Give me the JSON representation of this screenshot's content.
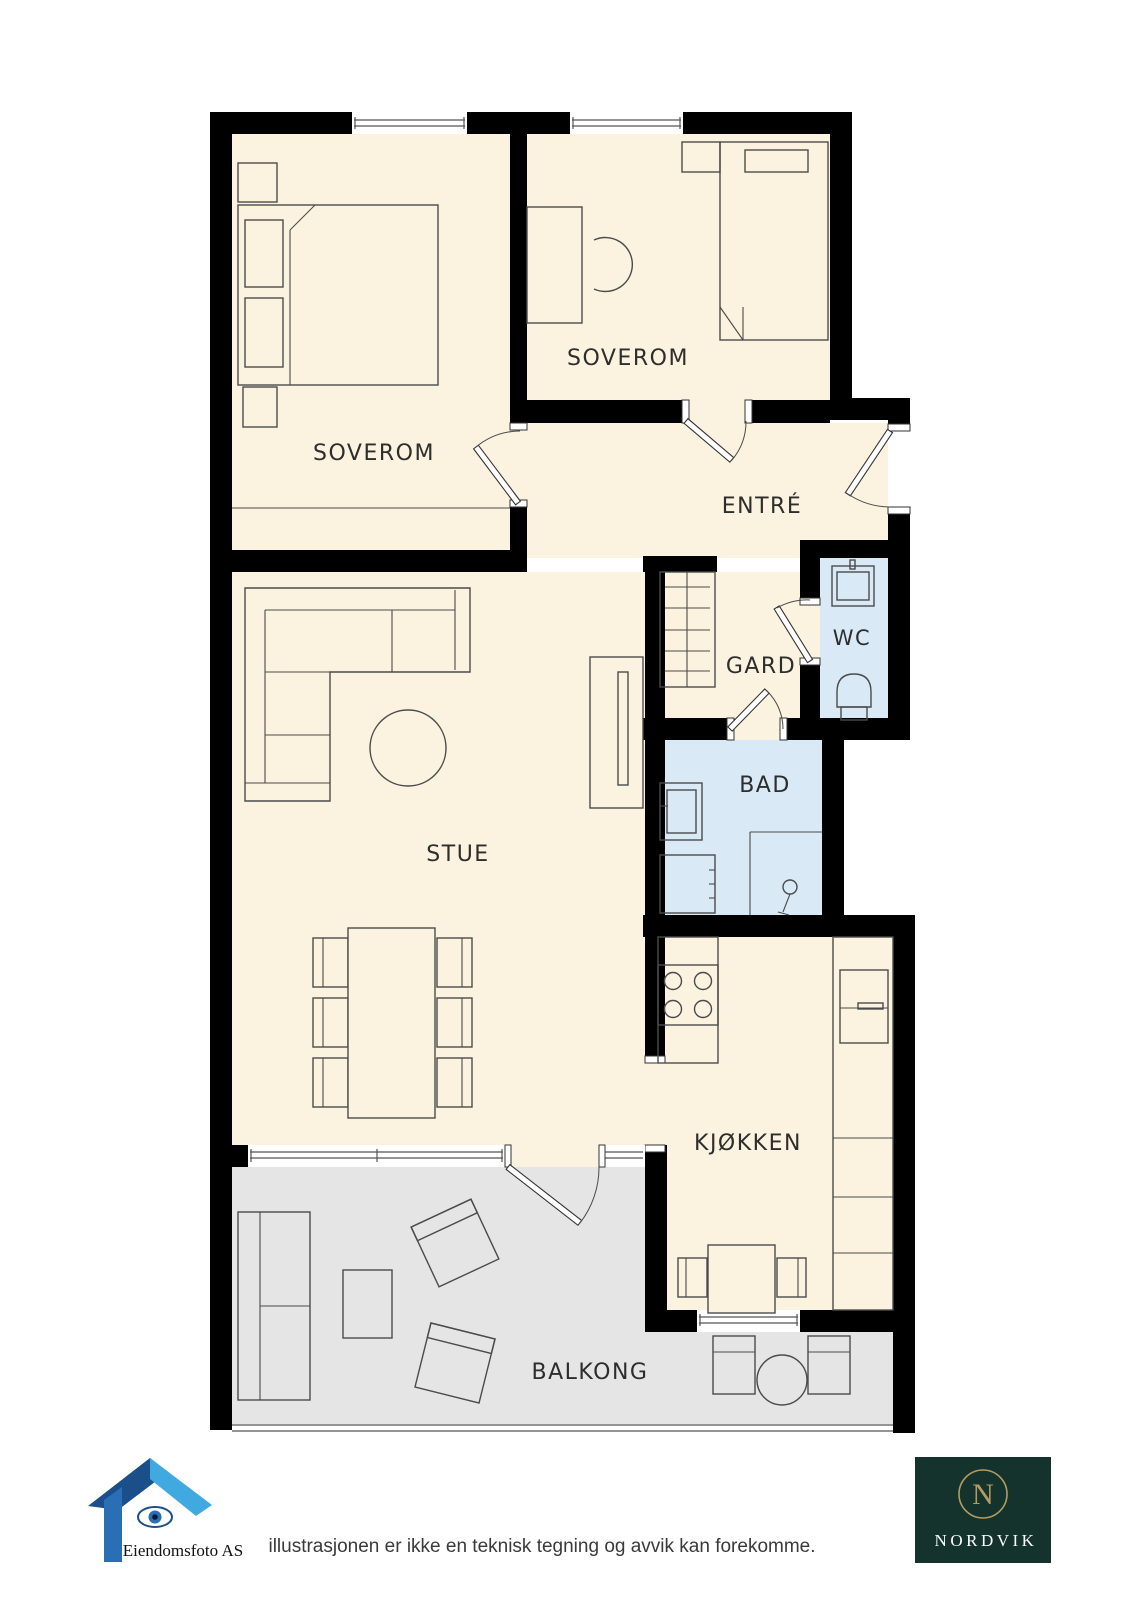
{
  "colors": {
    "background": "#ffffff",
    "wall": "#000000",
    "floor": "#FBF3DF",
    "wet_room": "#D9E9F6",
    "balcony": "#E5E5E5",
    "furniture_outline": "#4b4b4b",
    "label_text": "#2d2d2d",
    "footer_text": "#3a3a3a",
    "nordvik_bg": "#14332D",
    "nordvik_gold": "#B59B62",
    "nordvik_text": "#ffffff",
    "logo_blue_dark": "#1a4f8a",
    "logo_blue_light": "#3fa9e0"
  },
  "rooms": {
    "soverom_left": {
      "label": "SOVEROM"
    },
    "soverom_top": {
      "label": "SOVEROM"
    },
    "entre": {
      "label": "ENTRÉ"
    },
    "gard": {
      "label": "GARD"
    },
    "wc": {
      "label": "WC"
    },
    "bad": {
      "label": "BAD"
    },
    "stue": {
      "label": "STUE"
    },
    "kjokken": {
      "label": "KJØKKEN"
    },
    "balkong": {
      "label": "BALKONG"
    }
  },
  "footer": {
    "disclaimer": "illustrasjonen er ikke en teknisk tegning og avvik kan forekomme.",
    "photo_credit": "Eiendomsfoto AS",
    "brand": "NORDVIK",
    "brand_monogram": "N"
  }
}
